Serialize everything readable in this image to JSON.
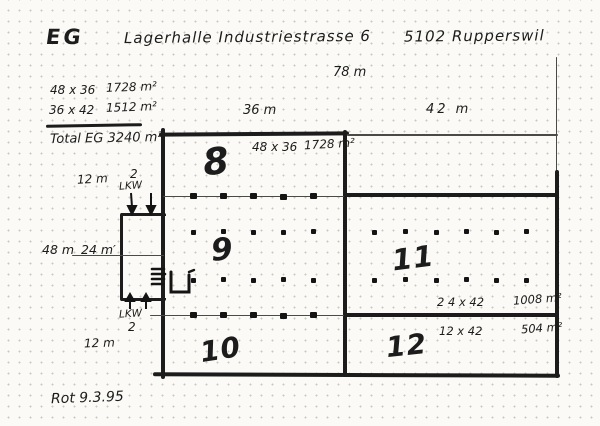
{
  "header": {
    "title": "EG",
    "project": "Lagerhalle Industriestrasse 6",
    "city": "5102 Rupperswil"
  },
  "calc": {
    "row1_dims": "48 x 36",
    "row1_area": "1728 m²",
    "row2_dims": "36 x 42",
    "row2_area": "1512 m²",
    "total": "Total EG 3240 m²"
  },
  "dimensions": {
    "total_width": "78 m",
    "left_width": "36 m",
    "right_width": "42 m",
    "top_band_height": "12 m",
    "building_height": "48 m",
    "half_height": "24 m′",
    "bottom_band_height": "12 m"
  },
  "rooms": {
    "r8": {
      "number": "8",
      "dims": "48 x 36",
      "area": "1728 m²"
    },
    "r9": {
      "number": "9"
    },
    "r10": {
      "number": "10"
    },
    "r11": {
      "number": "11",
      "dims": "2 4 x 42",
      "area": "1008 m²"
    },
    "r12": {
      "number": "12",
      "dims": "12 x 42",
      "area": "504 m²"
    }
  },
  "annotations": {
    "lkw_top_count": "2",
    "lkw_top_label": "LKW",
    "lkw_bottom_label": "LKW",
    "lkw_bottom_count": "2",
    "date_note": "Rot  9.3.95"
  },
  "colors": {
    "ink": "#1c1c1c",
    "paper": "#fbfaf6",
    "grid_dots": "#c8c8c0"
  }
}
